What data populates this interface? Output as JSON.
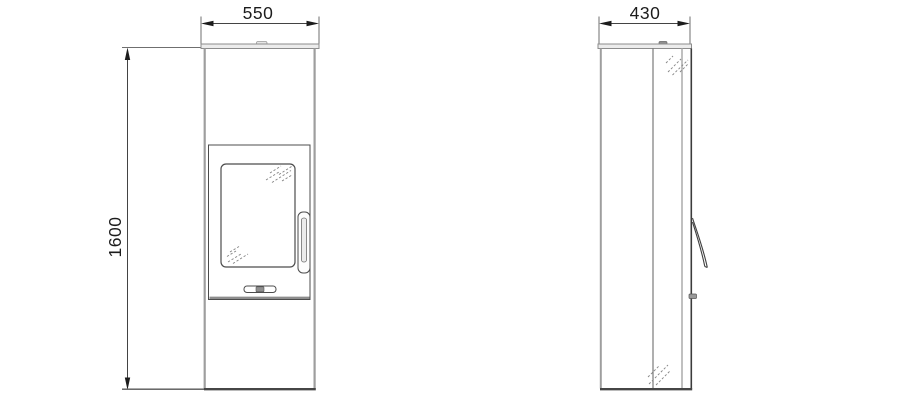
{
  "diagram": {
    "type": "technical-drawing",
    "subject": "stove-two-view-dimension-drawing",
    "front_view": {
      "width_label": "550",
      "height_label": "1600"
    },
    "side_view": {
      "depth_label": "430"
    },
    "colors": {
      "background": "#ffffff",
      "line_dark": "#434343",
      "line_gray": "#9e9e9e",
      "line_light": "#b5b5b5",
      "extension_line": "#6f6f6f",
      "text": "#1c1c1c",
      "plate_fill": "#ececec",
      "knob_fill": "#8f8f8f"
    }
  }
}
